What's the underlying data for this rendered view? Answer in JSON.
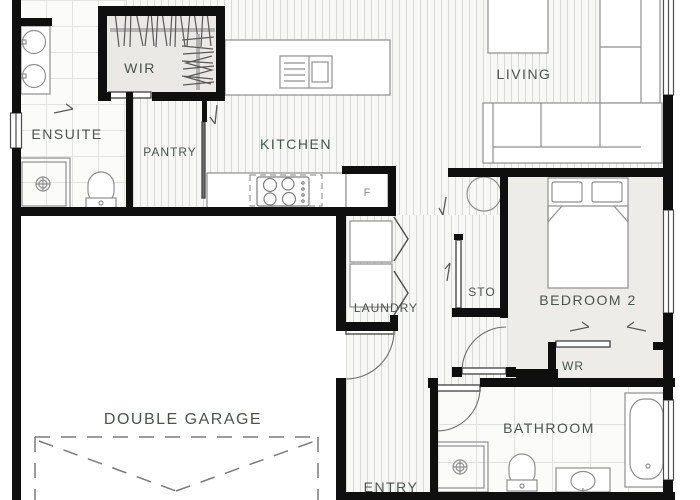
{
  "rooms": {
    "wir": "WIR",
    "ensuite": "ENSUITE",
    "pantry": "PANTRY",
    "kitchen": "KITCHEN",
    "living": "LIVING",
    "bedroom2": "BEDROOM 2",
    "sto": "STO",
    "wr": "WR",
    "laundry": "LAUNDRY",
    "double_garage": "DOUBLE GARAGE",
    "bathroom": "BATHROOM",
    "entry": "ENTRY"
  },
  "fixtures": {
    "fridge_label": "F"
  },
  "colors": {
    "wall": "#0f0f0f",
    "label_text": "#4a544c",
    "fixture_line": "#8f8f8f",
    "floor_line": "#d9d9d5",
    "floor_bg": "#f7f7f5",
    "carpet": "#edece8",
    "tile_line": "#e3e3e0"
  }
}
